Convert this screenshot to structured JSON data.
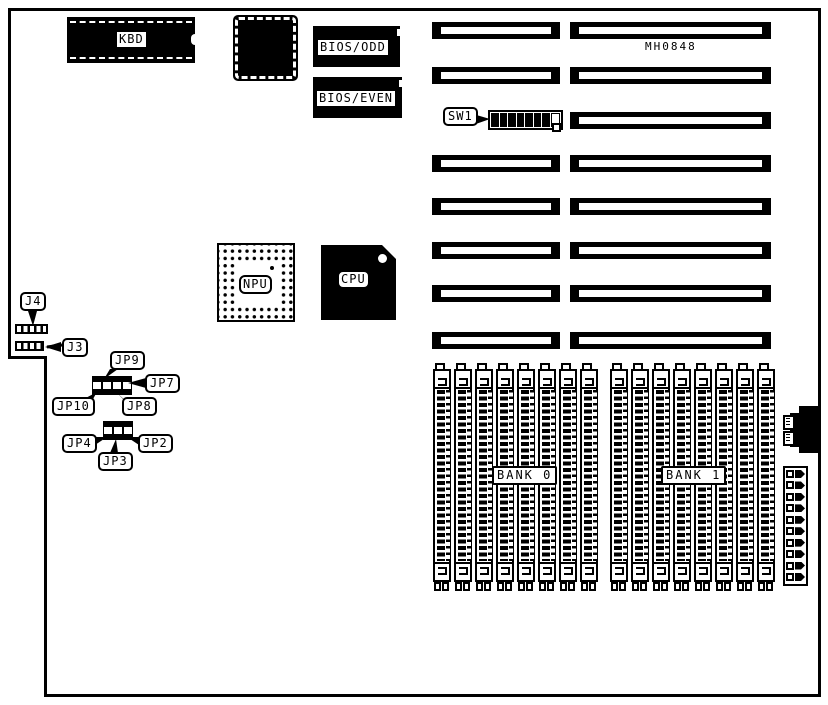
{
  "board": {
    "part_number": "MH0848"
  },
  "chips": {
    "kbd": "KBD",
    "bios_odd": "BIOS/ODD",
    "bios_even": "BIOS/EVEN",
    "npu": "NPU",
    "cpu": "CPU"
  },
  "connectors": {
    "j4": "J4",
    "j3": "J3"
  },
  "switch": {
    "label": "SW1",
    "positions": [
      1,
      1,
      1,
      1,
      1,
      1,
      1,
      0
    ]
  },
  "jumpers": {
    "jp9": "JP9",
    "jp7": "JP7",
    "jp10": "JP10",
    "jp8": "JP8",
    "jp4": "JP4",
    "jp3": "JP3",
    "jp2": "JP2"
  },
  "memory": {
    "banks": [
      {
        "label": "BANK 0",
        "simms": 8
      },
      {
        "label": "BANK 1",
        "simms": 8
      }
    ]
  },
  "pin_header": {
    "rows": 10
  },
  "colors": {
    "ink": "#000000",
    "paper": "#ffffff"
  }
}
